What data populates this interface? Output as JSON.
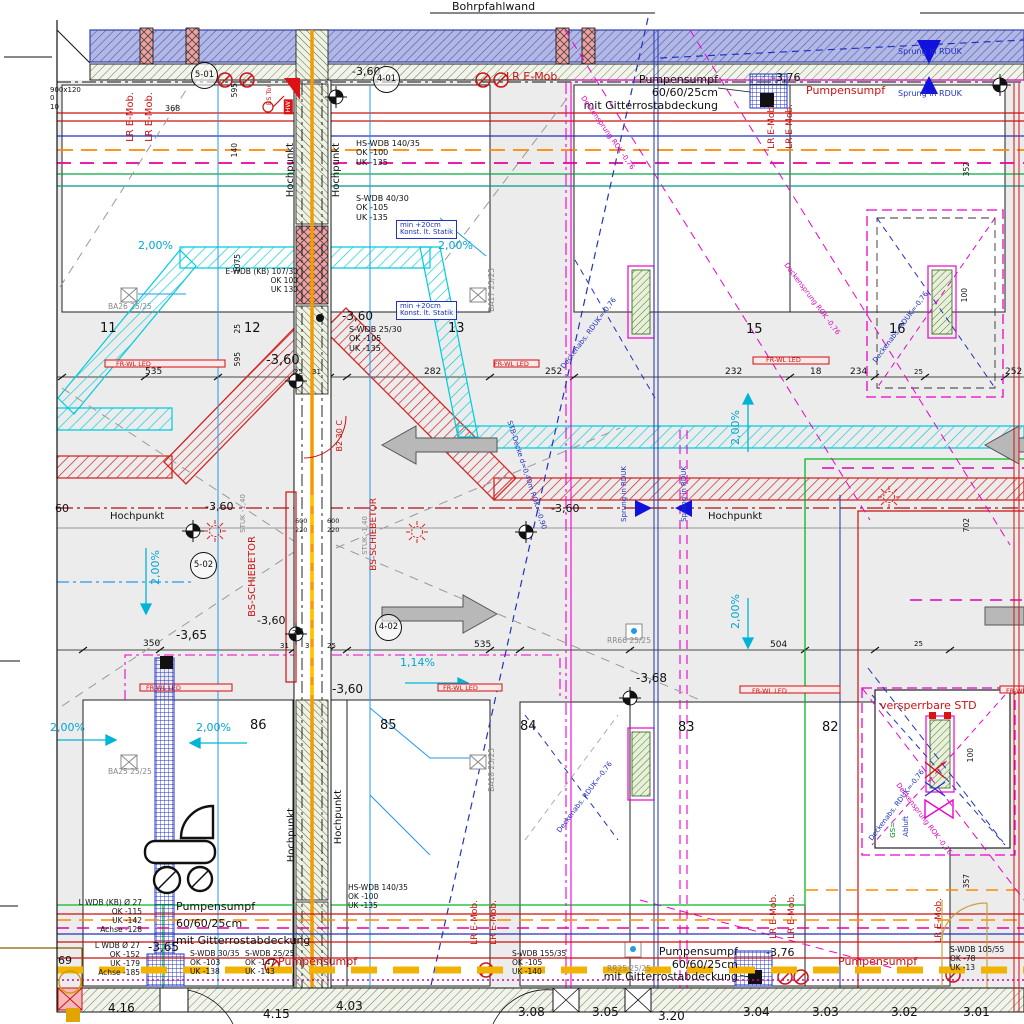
{
  "labels": {
    "bohrpfahlwand": "Bohrpfahlwand",
    "hochpunkt": "Hochpunkt",
    "pumpensumpf": "Pumpensumpf",
    "pump_size": "60/60/25cm",
    "pump_cover": "mit Gitterrostabdeckung",
    "lr_emob": "LR E-Mob.",
    "fr_wl_led": "FR-WL LED",
    "bs_schiebetor": "BS-SCHIEBETOR",
    "bs_tor": "BS Tor",
    "hw": "HW",
    "versperrbare_std": "versperrbare STD",
    "sprung_rduk": "Sprung in RDUK",
    "min1": "min +20cm",
    "min2": "Konst. lt. Statik",
    "stuk": "STUK -1,40",
    "b2": "B2 30 C",
    "deckenabs": "Deckenabs. RDUK=-0,76",
    "stb_decke": "STB-Decke d=0,40m ROK=-0,90",
    "deckensprung": "Deckensprung ROK -0,76",
    "gs": "GS=",
    "abluft": "Abluft",
    "marker69": "69"
  },
  "levels": {
    "m360": "-3,60",
    "m365": "-3,65",
    "m368": "-3,68",
    "m376": "-3,76",
    "m360cut": "60"
  },
  "slopes": {
    "p200": "2,00%",
    "p114": "1,14%"
  },
  "datums": [
    "5-01",
    "4-01",
    "5-02",
    "4-02"
  ],
  "parking": [
    "11",
    "12",
    "13",
    "15",
    "16",
    "86",
    "85",
    "84",
    "83",
    "82"
  ],
  "rooms": [
    "4.16",
    "4.15",
    "4.03",
    "3.08",
    "3.05",
    "3.20",
    "3.04",
    "3.03",
    "3.02",
    "3.01"
  ],
  "dims": {
    "top": [
      "535",
      "25",
      "31",
      "282",
      "252",
      "232",
      "18",
      "234",
      "25",
      "252"
    ],
    "mid": [
      "350",
      "25",
      "31",
      "3",
      "25",
      "535",
      "504",
      "25"
    ],
    "vert": [
      "595",
      "140",
      "1075",
      "25",
      "595",
      "352",
      "702",
      "100",
      "100",
      "357"
    ],
    "small": [
      "368",
      "900x120",
      "0",
      "10",
      "600",
      "220"
    ]
  },
  "specs": {
    "hs_wdb": [
      "HS-WDB 140/35",
      "OK -100",
      "UK -135"
    ],
    "s_wdb_4030": [
      "S-WDB 40/30",
      "OK -105",
      "UK -135"
    ],
    "e_wdb": [
      "E-WDB (KB) 107/30",
      "OK 100",
      "UK 130"
    ],
    "s_wdb_2530": [
      "S-WDB 25/30",
      "OK -105",
      "UK -135"
    ],
    "l_wdb_kb": [
      "L WDB (KB) Ø 27",
      "OK -115",
      "UK -142",
      "Achse -128"
    ],
    "l_wdb": [
      "L WDB Ø 27",
      "OK -152",
      "UK -179",
      "Achse -185"
    ],
    "s_wdb_3035": [
      "S-WDB 30/35",
      "OK -103",
      "UK -138"
    ],
    "s_wdb_2525": [
      "S-WDB 25/25",
      "OK -147",
      "UK -143"
    ],
    "s_wdb_15535": [
      "S-WDB 155/35",
      "OK -105",
      "UK -140"
    ],
    "s_wdb_10555": [
      "S-WDB 105/55",
      "OK -78",
      "UK -13"
    ],
    "hs_wdb_b": [
      "HS-WDB 140/35",
      "OK -100",
      "UK -135"
    ]
  },
  "col_refs": [
    "BA26 25/25",
    "BA17 25/25",
    "BA25 25/25",
    "BA18 25/25",
    "RR66 25/25",
    "RR25 25/25"
  ],
  "colors": {
    "wall_red": "#d42222",
    "channel_cyan": "#00ccdd",
    "pile_blue": "#b2b7e4",
    "slope_cyan": "#00a6d4",
    "marking_magenta": "#dd00bb",
    "axis_orange": "#f59a00",
    "grating_blue": "#2233cc",
    "line_green": "#00aa44"
  }
}
